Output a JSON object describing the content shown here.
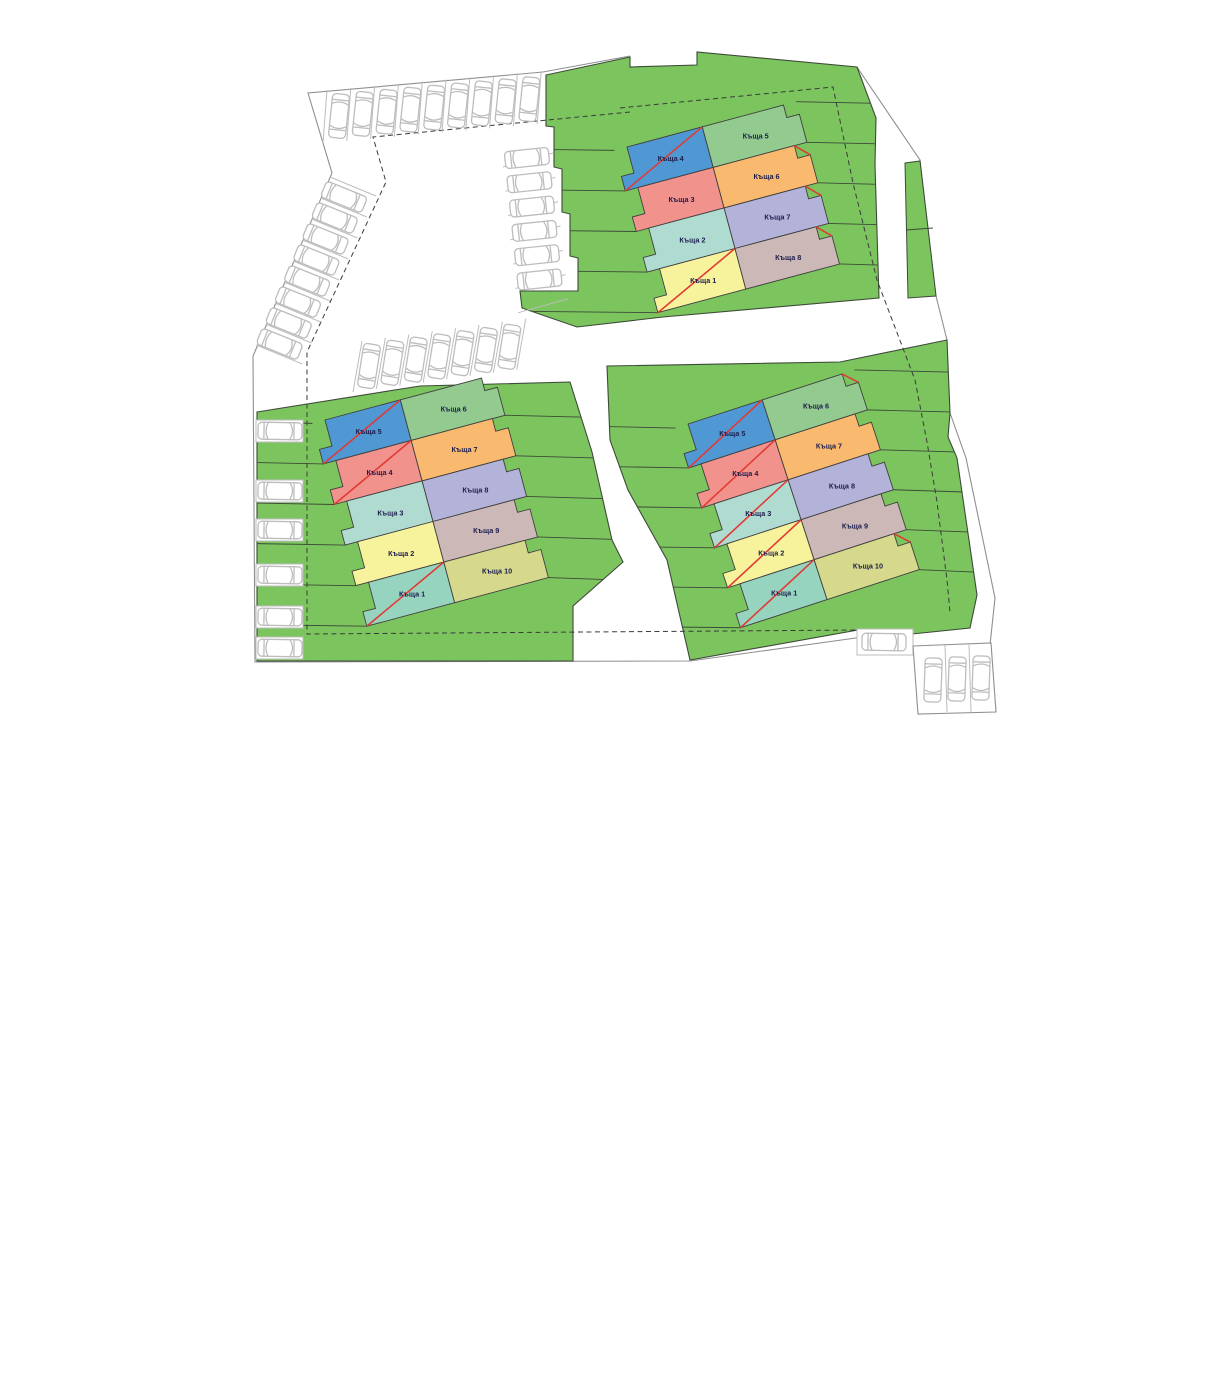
{
  "plan": {
    "language": "bg",
    "unit_word": "Къща",
    "sold_marker": "red-diagonal-cross"
  },
  "colors": {
    "plot_green": "#7cc55e",
    "plot_line": "#3c4a38",
    "boundary_gray": "#8f8f8f",
    "car_gray": "#bdbdbd",
    "sold_red": "#e23a35",
    "label_text": "#1d1d4e",
    "house_palette": {
      "blue": "#4f98d3",
      "salmon": "#f2928c",
      "teal": "#b0dbd1",
      "yellow": "#f7f39d",
      "mint": "#96d4bf",
      "green": "#93ca8f",
      "orange": "#f9b96e",
      "lavender": "#b3b2d9",
      "tan": "#ccb9b7",
      "olive": "#d6d98c"
    }
  },
  "clusters": [
    {
      "name": "north-cluster",
      "left": [
        {
          "label": "Къща 4",
          "color": "blue",
          "sold": true
        },
        {
          "label": "Къща 3",
          "color": "salmon",
          "sold": false
        },
        {
          "label": "Къща 2",
          "color": "teal",
          "sold": false
        },
        {
          "label": "Къща 1",
          "color": "yellow",
          "sold": true
        }
      ],
      "right": [
        {
          "label": "Къща 5",
          "color": "green",
          "sold": false
        },
        {
          "label": "Къща 6",
          "color": "orange",
          "sold": true
        },
        {
          "label": "Къща 7",
          "color": "lavender",
          "sold": true
        },
        {
          "label": "Къща 8",
          "color": "tan",
          "sold": true
        }
      ]
    },
    {
      "name": "west-cluster",
      "left": [
        {
          "label": "Къща 5",
          "color": "blue",
          "sold": true
        },
        {
          "label": "Къща 4",
          "color": "salmon",
          "sold": true
        },
        {
          "label": "Къща 3",
          "color": "teal",
          "sold": false
        },
        {
          "label": "Къща 2",
          "color": "yellow",
          "sold": false
        },
        {
          "label": "Къща 1",
          "color": "mint",
          "sold": true
        }
      ],
      "right": [
        {
          "label": "Къща 6",
          "color": "green",
          "sold": false
        },
        {
          "label": "Къща 7",
          "color": "orange",
          "sold": false
        },
        {
          "label": "Къща 8",
          "color": "lavender",
          "sold": false
        },
        {
          "label": "Къща 9",
          "color": "tan",
          "sold": false
        },
        {
          "label": "Къща 10",
          "color": "olive",
          "sold": false
        }
      ]
    },
    {
      "name": "east-cluster",
      "left": [
        {
          "label": "Къща 5",
          "color": "blue",
          "sold": true
        },
        {
          "label": "Къща 4",
          "color": "salmon",
          "sold": true
        },
        {
          "label": "Къща 3",
          "color": "teal",
          "sold": true
        },
        {
          "label": "Къща 2",
          "color": "yellow",
          "sold": true
        },
        {
          "label": "Къща 1",
          "color": "mint",
          "sold": true
        }
      ],
      "right": [
        {
          "label": "Къща 6",
          "color": "green",
          "sold": true
        },
        {
          "label": "Къща 7",
          "color": "orange",
          "sold": false
        },
        {
          "label": "Къща 8",
          "color": "lavender",
          "sold": false
        },
        {
          "label": "Къща 9",
          "color": "tan",
          "sold": false
        },
        {
          "label": "Къща 10",
          "color": "olive",
          "sold": true
        }
      ]
    }
  ]
}
